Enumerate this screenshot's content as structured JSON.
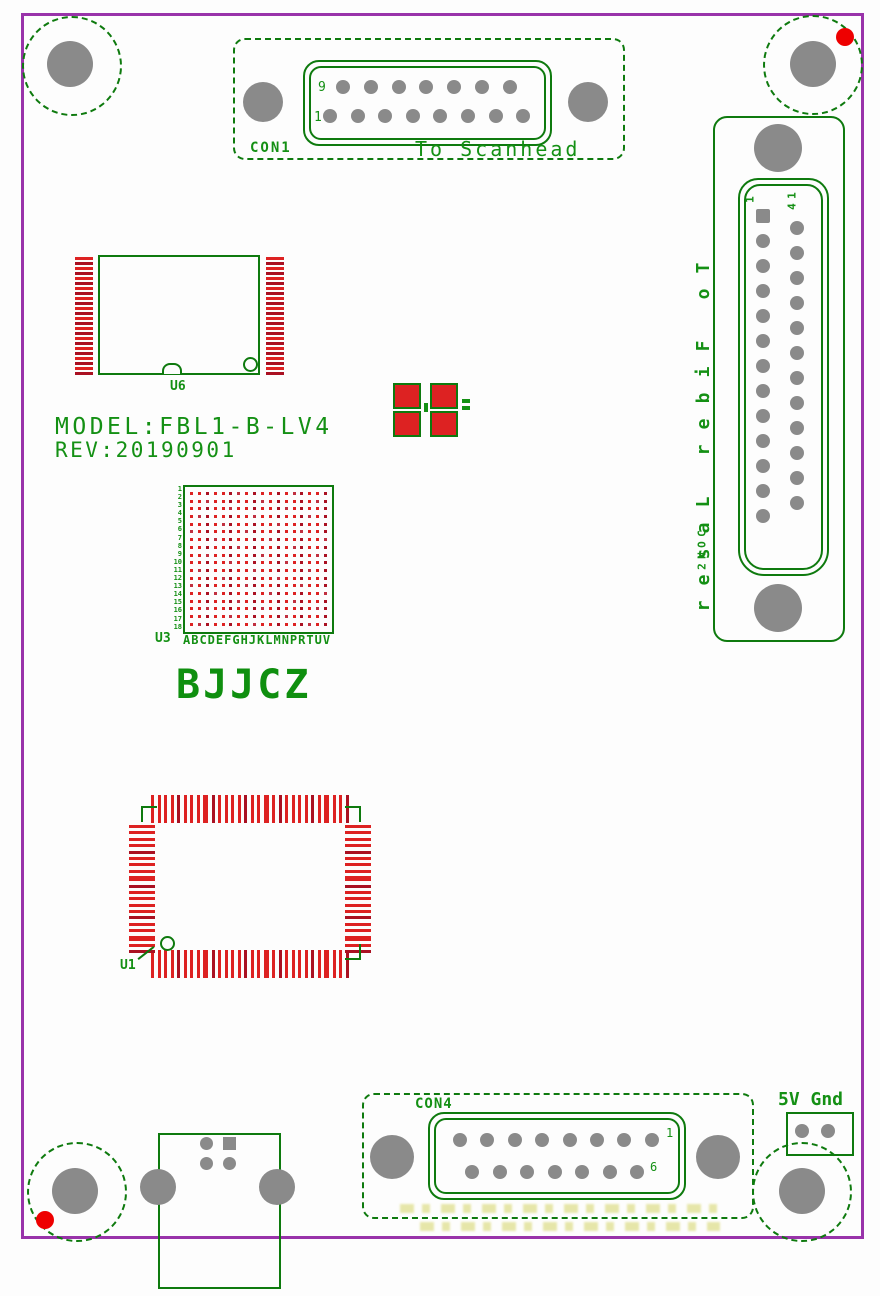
{
  "board": {
    "model": "MODEL:FBL1-B-LV4",
    "rev": "REV:20190901",
    "brand": "BJJCZ"
  },
  "con1": {
    "ref": "CON1",
    "label": "To Scanhead",
    "top_pin_label": "9",
    "bottom_pin_label": "1",
    "top_pins": 7,
    "bottom_pins": 8
  },
  "con2": {
    "ref": "CON2",
    "label": "To Fiber Laser",
    "col1_pin_label": "1",
    "col2_pin_label": "14",
    "col1_pins": 13,
    "col2_pins": 12
  },
  "con4": {
    "ref": "CON4",
    "right_top_pin_label": "1",
    "right_bottom_pin_label": "6",
    "top_pins": 8,
    "bottom_pins": 7
  },
  "power_header": {
    "label": "5V Gnd",
    "pad_count": 2
  },
  "u6": {
    "ref": "U6",
    "side_pad_count": 24
  },
  "u3": {
    "ref": "U3",
    "ball_grid_rows": 18,
    "ball_grid_cols": 18,
    "column_letters": "ABCDEFGHJKLMNPRTUV",
    "row_numbers": "1\n2\n3\n4\n5\n6\n7\n8\n9\n10\n11\n12\n13\n14\n15\n16\n17\n18"
  },
  "u1": {
    "ref": "U1",
    "horizontal_pad_count": 30,
    "vertical_pad_count": 20
  },
  "colors": {
    "board_outline": "#9933AA",
    "silkscreen_green": "#0E7A0E",
    "text_green": "#149014",
    "pad_red": "#DD2222",
    "pad_red_dark": "#AA1122",
    "drill_gray": "#8A8A8A",
    "marker_red": "#EE0000",
    "faint_yellow": "#CCCC44"
  }
}
